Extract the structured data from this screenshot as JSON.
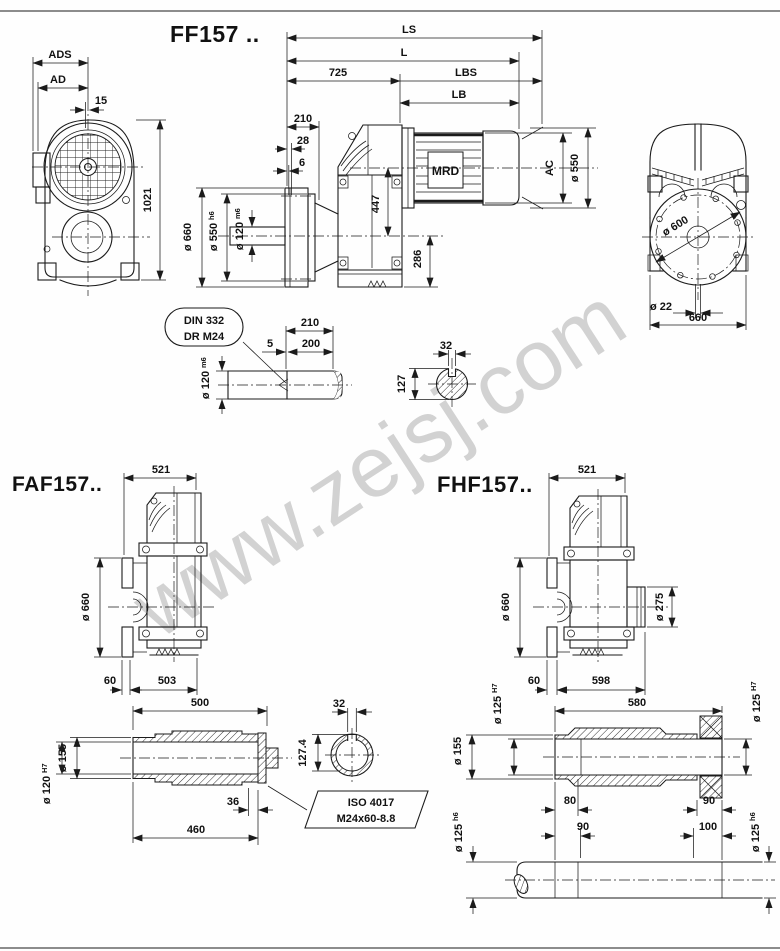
{
  "frame": {
    "watermark": "www.zejsj.com"
  },
  "titles": {
    "ff": "FF157 ..",
    "faf": "FAF157..",
    "fhf": "FHF157.."
  },
  "front": {
    "ads": "ADS",
    "ad": "AD",
    "off": "15",
    "h": "1021"
  },
  "side": {
    "ls": "LS",
    "l": "L",
    "n725": "725",
    "lbs": "LBS",
    "lb": "LB",
    "n210": "210",
    "n28": "28",
    "n6": "6",
    "n447": "447",
    "n286": "286",
    "d660": "ø 660",
    "d550": {
      "t": "ø 550",
      "s": "h6"
    },
    "d120": {
      "t": "ø 120",
      "s": "m6"
    },
    "ac": "AC",
    "d550r": "ø 550",
    "motor": "MRD"
  },
  "rear": {
    "d600": "ø 600",
    "d22": "ø 22",
    "n660": "660"
  },
  "mid": {
    "c1": "DIN 332",
    "c2": "DR M24",
    "n210": "210",
    "n5": "5",
    "n200": "200",
    "d120": {
      "t": "ø 120",
      "s": "m6"
    },
    "n32": "32",
    "n127": "127"
  },
  "faf": {
    "n521": "521",
    "d660": "ø 660",
    "n60": "60",
    "n503": "503"
  },
  "fafshaft": {
    "n500": "500",
    "d155": "ø 155",
    "d120": {
      "t": "ø 120",
      "s": "H7"
    },
    "n36": "36",
    "n460": "460",
    "n32": "32",
    "n1274": "127.4",
    "iso1": "ISO 4017",
    "iso2": "M24x60-8.8"
  },
  "fhf": {
    "n521": "521",
    "d660": "ø 660",
    "d275": "ø 275",
    "n60": "60",
    "n598": "598"
  },
  "fhfshaft": {
    "n580": "580",
    "d125l": {
      "t": "ø 125",
      "s": "H7"
    },
    "d155": "ø 155",
    "d125r": {
      "t": "ø 125",
      "s": "H7"
    },
    "n80": "80",
    "n90a": "90",
    "n90b": "90",
    "n100": "100",
    "d125hl": {
      "t": "ø 125",
      "s": "h6"
    },
    "d125hr": {
      "t": "ø 125",
      "s": "h6"
    }
  }
}
